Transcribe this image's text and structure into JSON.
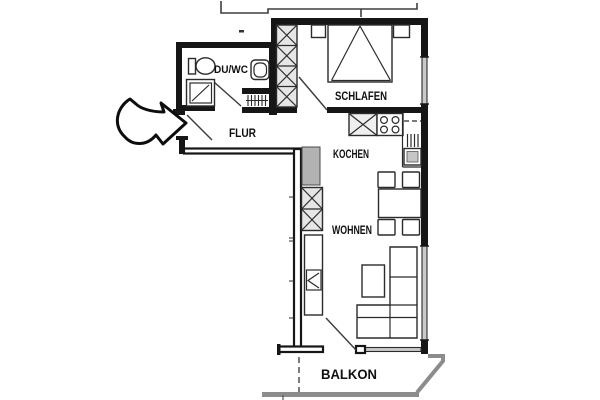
{
  "plan": {
    "labels": {
      "du_wc": "DU/WC",
      "schlafen": "SCHLAFEN",
      "flur": "FLUR",
      "kochen": "KOCHEN",
      "wohnen": "WOHNEN",
      "balkon": "BALKON"
    },
    "colors": {
      "background": "#ffffff",
      "wall": "#161616",
      "line": "#2b2b2b",
      "window_fill": "#c9c9c9",
      "shaft_fill": "#b2b2b2",
      "closet_fill": "#e6e6e6",
      "sink_fill": "#efefef",
      "appliance_fill": "#c6c6c6",
      "railing": "#8c8c8c"
    }
  }
}
